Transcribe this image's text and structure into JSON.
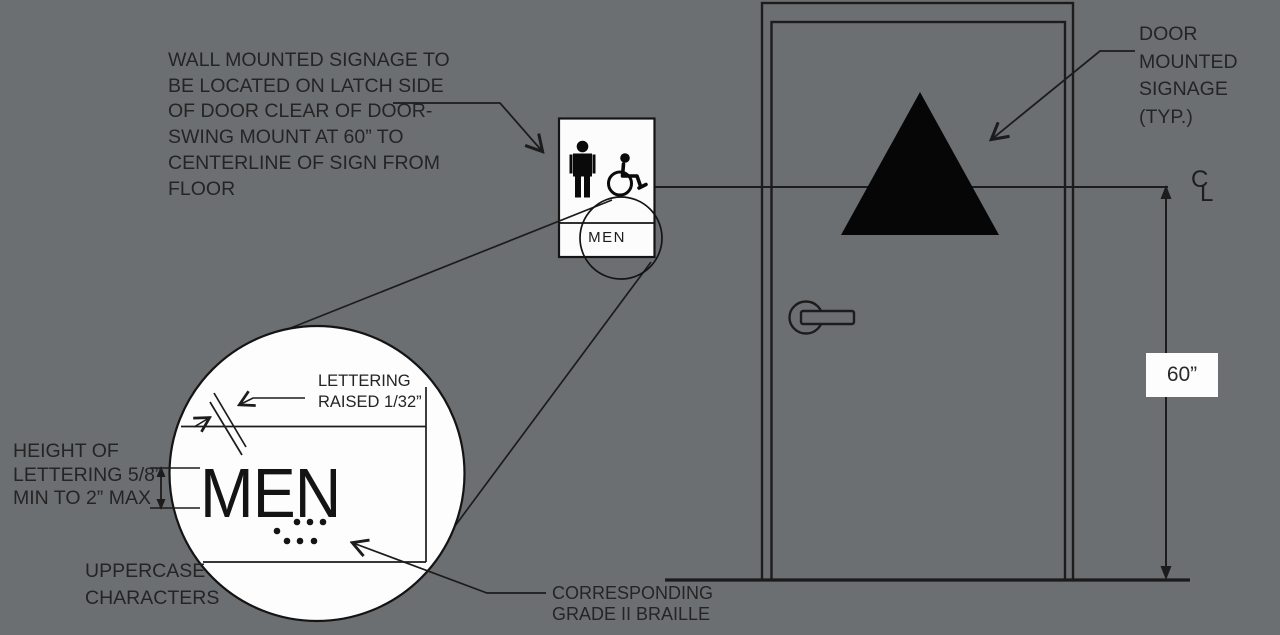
{
  "diagram": {
    "title_semantic": "ADA restroom door signage mounting detail",
    "background_color": "#6c6f72",
    "line_color": "#1c1c1c",
    "text_color": "#242424",
    "sign_fill": "#fdfdfd",
    "icon_color": "#0a0a0a"
  },
  "labels": {
    "wall_note": "WALL MOUNTED SIGNAGE TO\nBE LOCATED ON LATCH SIDE\nOF DOOR CLEAR OF DOOR-\nSWING MOUNT AT 60” TO\nCENTERLINE OF SIGN FROM\nFLOOR",
    "door_note": "DOOR\nMOUNTED\nSIGNAGE\n(TYP.)",
    "lettering_note": "LETTERING\nRAISED 1/32”",
    "height_note": "HEIGHT OF\nLETTERING 5/8”\nMIN TO 2” MAX",
    "uppercase_note": "UPPERCASE\nCHARACTERS",
    "braille_note": "CORRESPONDING\nGRADE II BRAILLE",
    "dimension_60": "60”",
    "centerline_c": "C",
    "centerline_l": "L",
    "sign_text": "MEN",
    "detail_text": "MEN"
  }
}
